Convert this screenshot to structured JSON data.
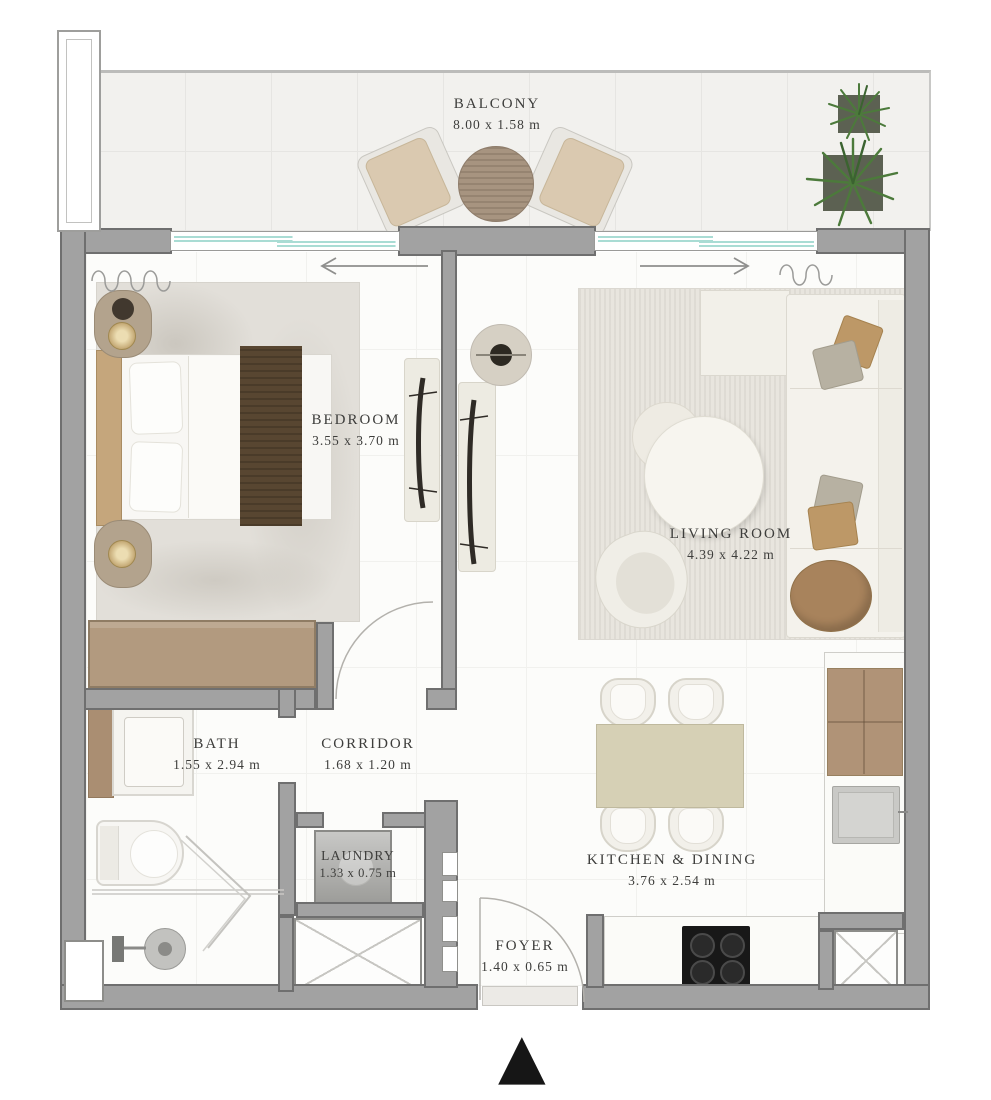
{
  "rooms": {
    "balcony": {
      "name": "BALCONY",
      "dims": "8.00 x 1.58 m"
    },
    "bedroom": {
      "name": "BEDROOM",
      "dims": "3.55 x 3.70 m"
    },
    "living_room": {
      "name": "LIVING ROOM",
      "dims": "4.39 x 4.22 m"
    },
    "bath": {
      "name": "BATH",
      "dims": "1.55 x 2.94 m"
    },
    "corridor": {
      "name": "CORRIDOR",
      "dims": "1.68 x 1.20 m"
    },
    "laundry": {
      "name": "LAUNDRY",
      "dims": "1.33 x 0.75 m"
    },
    "kitchen_dining": {
      "name": "KITCHEN & DINING",
      "dims": "3.76 x 2.54 m"
    },
    "foyer": {
      "name": "FOYER",
      "dims": "1.40 x 0.65 m"
    }
  },
  "icons": {
    "north_arrow": "▲"
  },
  "colors": {
    "wall": "#a2a2a2",
    "wall_edge": "#6f6f6f",
    "wood_tan": "#b29a7f",
    "bed_runner": "#584631",
    "dining_table": "#d6d0b5",
    "plant_green": "#4c7a3b",
    "glass_teal": "#a9dcd4",
    "cooktop_black": "#181818",
    "label_text": "#3d3d3b"
  }
}
